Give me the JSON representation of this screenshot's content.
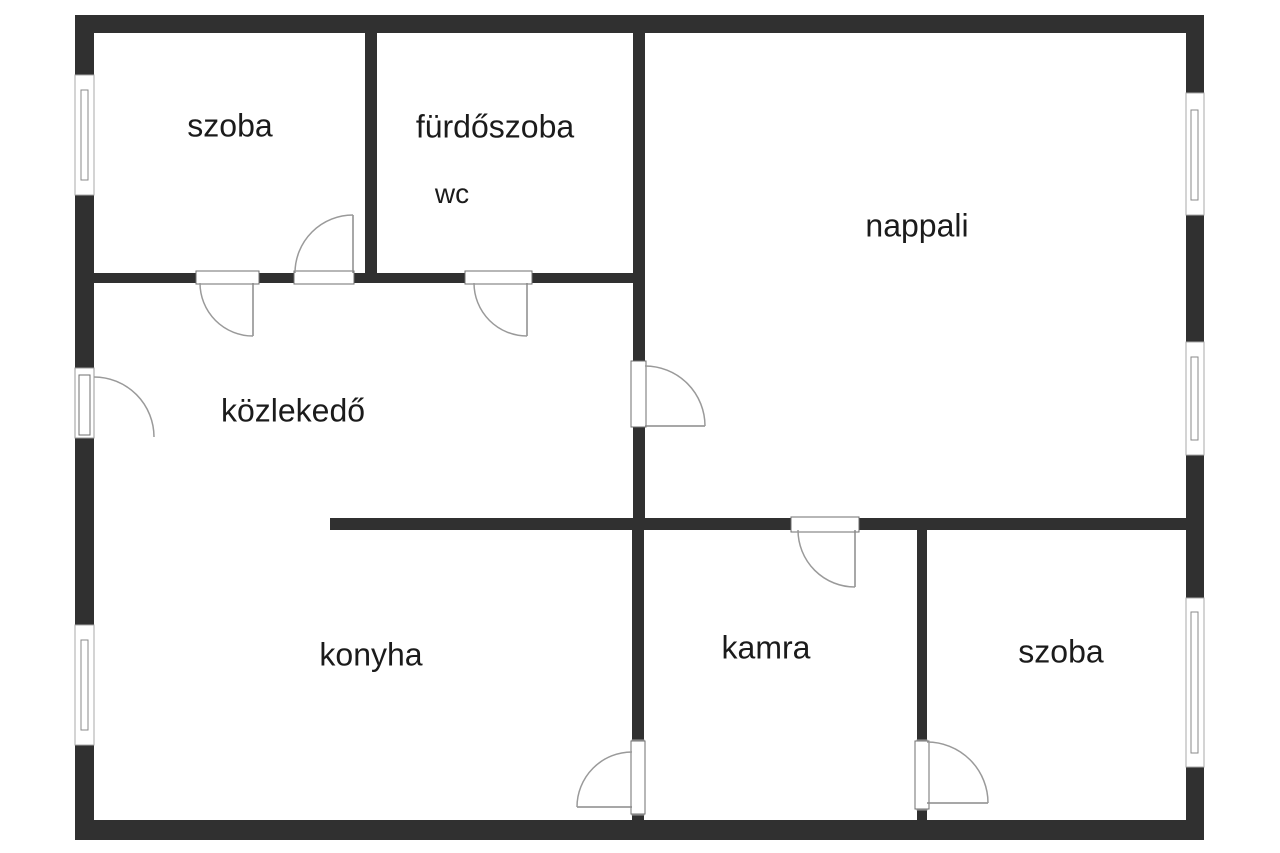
{
  "meta": {
    "type": "floor-plan",
    "language": "hu"
  },
  "colors": {
    "wall": "#303030",
    "line": "#9a9a9a",
    "text": "#1b1b1b",
    "background": "#ffffff"
  },
  "rooms": [
    {
      "id": "szoba-top-left",
      "label": "szoba"
    },
    {
      "id": "furdoszoba",
      "label": "fürdőszoba"
    },
    {
      "id": "wc",
      "label": "wc"
    },
    {
      "id": "nappali",
      "label": "nappali"
    },
    {
      "id": "kozlekedo",
      "label": "közlekedő"
    },
    {
      "id": "konyha",
      "label": "konyha"
    },
    {
      "id": "kamra",
      "label": "kamra"
    },
    {
      "id": "szoba-bottom-right",
      "label": "szoba"
    }
  ]
}
